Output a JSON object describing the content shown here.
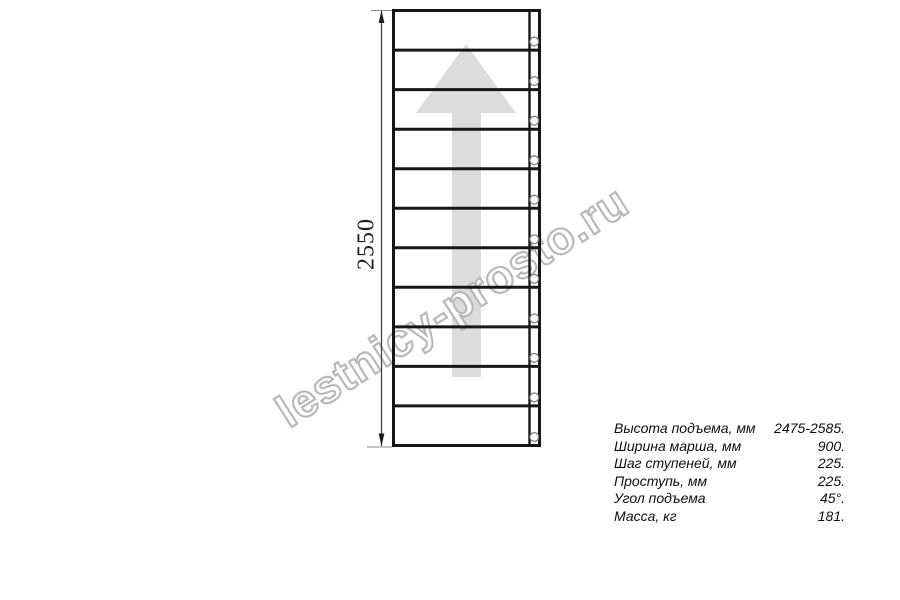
{
  "drawing": {
    "dimension_height_label": "2550"
  },
  "watermark": {
    "site_text": "lestnicy-prosto.ru"
  },
  "specs": {
    "rows": [
      {
        "label": "Высота подъема, мм",
        "value": "2475-2585."
      },
      {
        "label": "Ширина марша, мм",
        "value": "900."
      },
      {
        "label": "Шаг ступеней, мм",
        "value": "225."
      },
      {
        "label": "Проступь, мм",
        "value": "225."
      },
      {
        "label": "Угол подъема",
        "value": "45°."
      },
      {
        "label": "Масса, кг",
        "value": "181."
      }
    ]
  },
  "colors": {
    "line_black": "#161616",
    "arrow_gray": "#dcdcdc",
    "watermark_gray": "#b9b9b9"
  }
}
